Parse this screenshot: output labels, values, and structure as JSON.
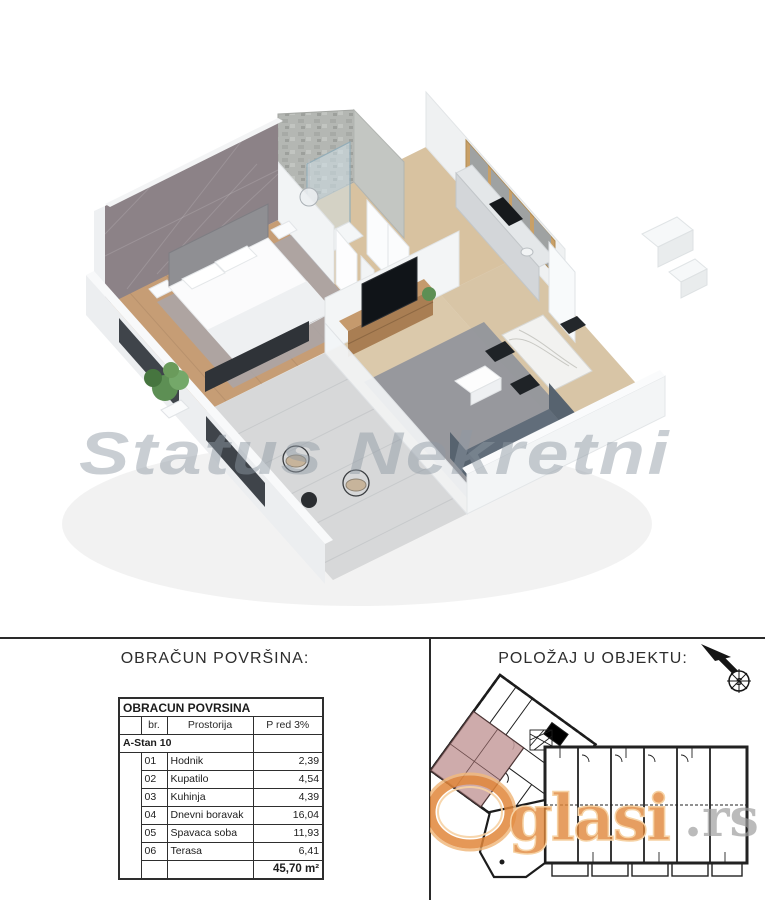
{
  "render": {
    "watermark": "Status Nekretni"
  },
  "areas": {
    "title": "OBRAČUN POVRŠINA:",
    "table": {
      "title": "OBRACUN POVRSINA",
      "columns": {
        "num": "br.",
        "room": "Prostorija",
        "area": "P red 3%"
      },
      "group": "A-Stan 10",
      "rows": [
        {
          "num": "01",
          "room": "Hodnik",
          "area": "2,39"
        },
        {
          "num": "02",
          "room": "Kupatilo",
          "area": "4,54"
        },
        {
          "num": "03",
          "room": "Kuhinja",
          "area": "4,39"
        },
        {
          "num": "04",
          "room": "Dnevni boravak",
          "area": "16,04"
        },
        {
          "num": "05",
          "room": "Spavaca soba",
          "area": "11,93"
        },
        {
          "num": "06",
          "room": "Terasa",
          "area": "6,41"
        }
      ],
      "total": "45,70 m²"
    }
  },
  "location": {
    "title": "POLOŽAJ U OBJEKTU:",
    "compass_label": "S",
    "watermark": {
      "part_glasi": "glasi",
      "part_rs": ".rs"
    }
  },
  "colors": {
    "accent_wall": "#8c8287",
    "highlight_unit_pink": "#c79f9f",
    "watermark_orange": "#e0863a",
    "watermark_gray_blue": "#97a0ab",
    "plan_line": "#1c1c1c",
    "cabinet_wood": "#c9a067",
    "sofa_slate": "#5e6a77",
    "floor_wood": "#c69d75"
  }
}
